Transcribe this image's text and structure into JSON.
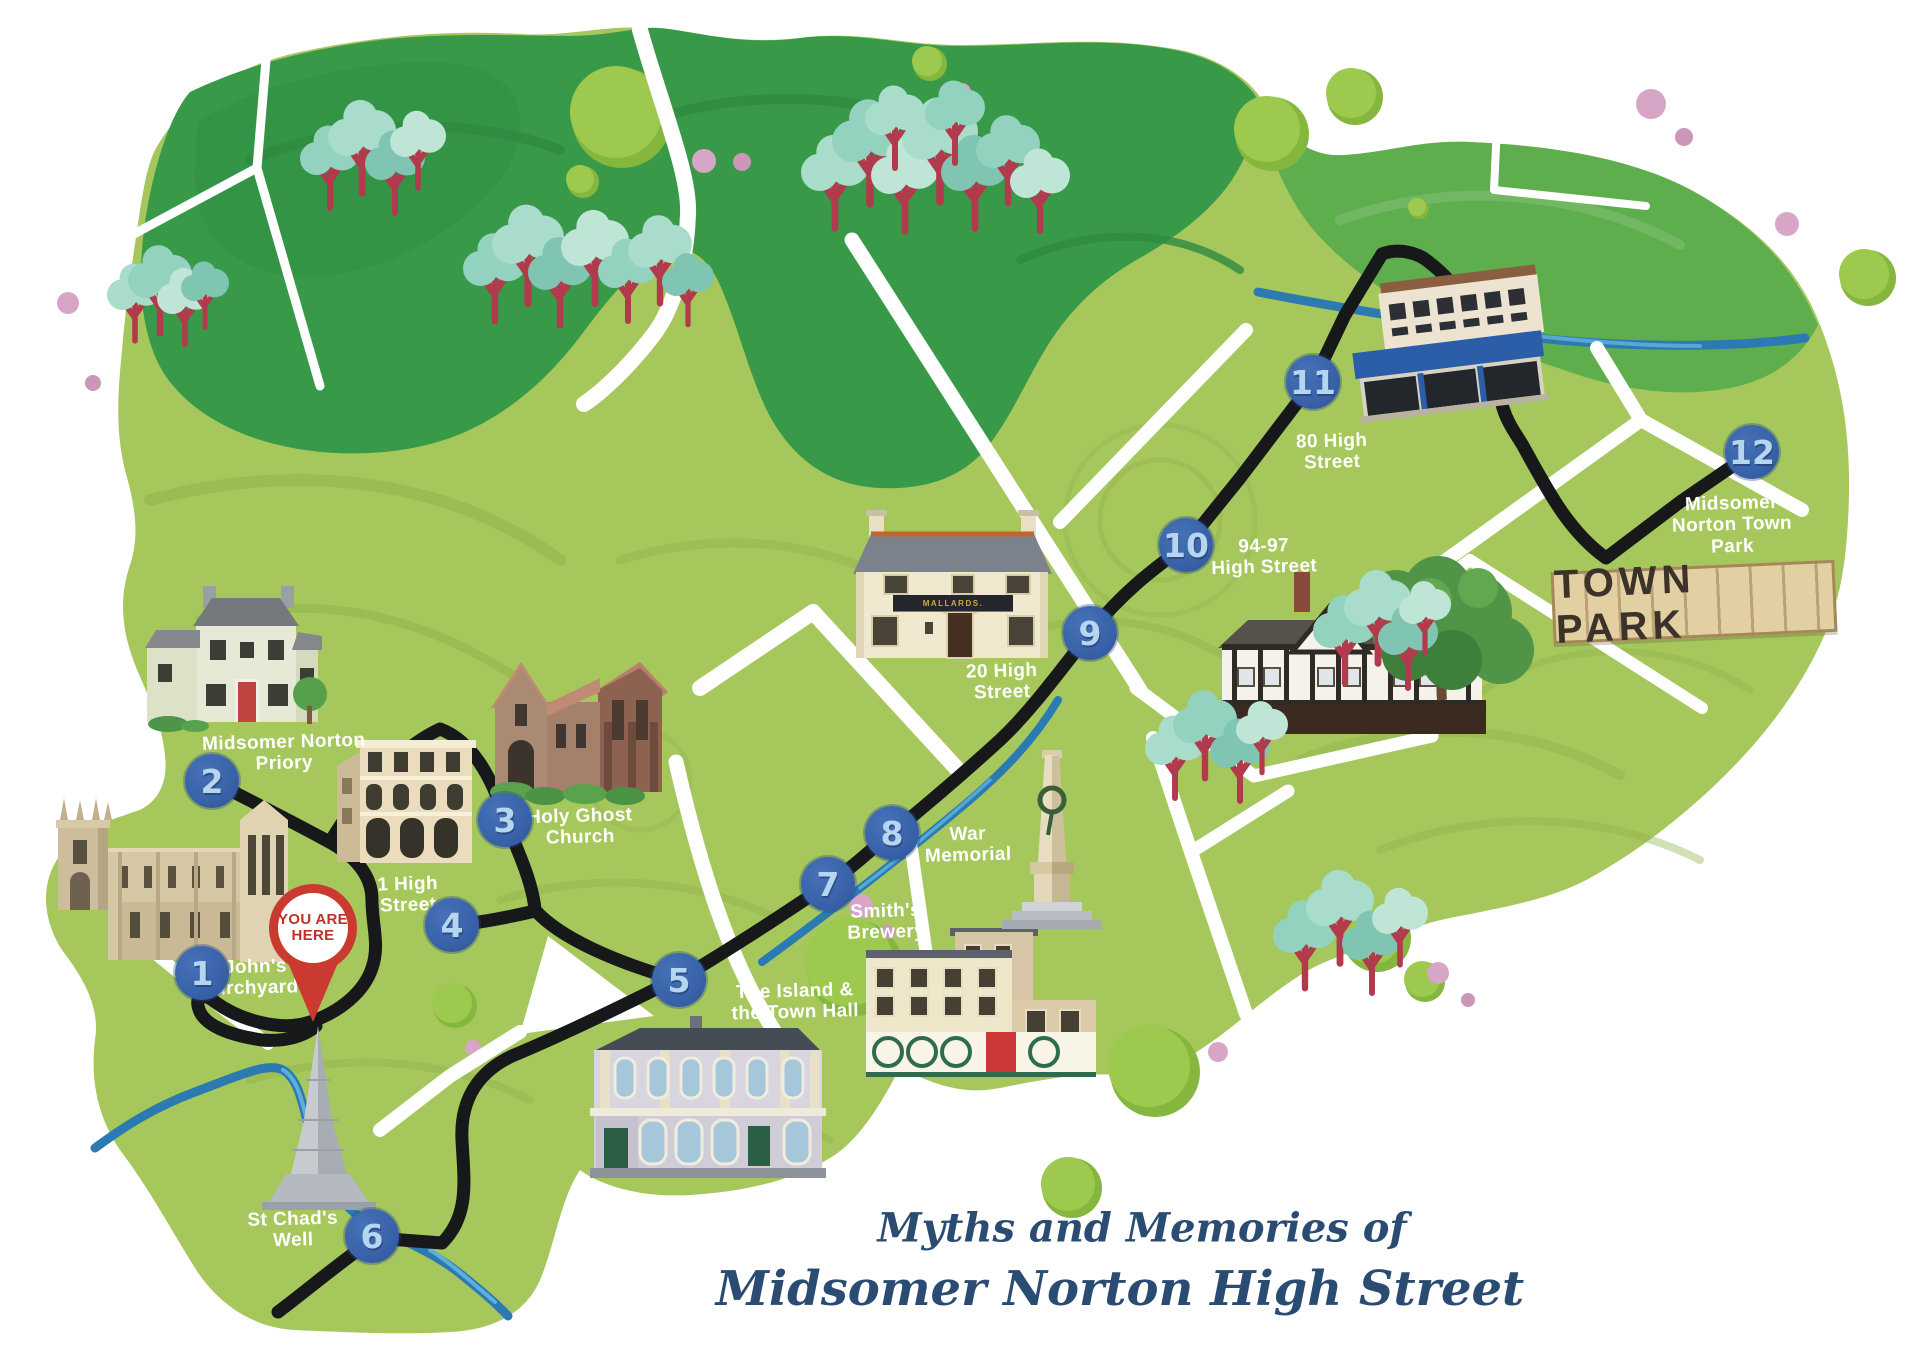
{
  "title": {
    "line1": "Myths and Memories of",
    "line2": "Midsomer Norton High Street"
  },
  "marker": {
    "you_are_here": "YOU ARE\nHERE"
  },
  "signs": {
    "town_park": "TOWN PARK",
    "building_20_high_street": "MALLARDS."
  },
  "stops": [
    {
      "number": "1",
      "label": "St John's\nChurchyard"
    },
    {
      "number": "2",
      "label": "Midsomer Norton\nPriory"
    },
    {
      "number": "3",
      "label": "Holy Ghost\nChurch"
    },
    {
      "number": "4",
      "label": "1 High\nStreet"
    },
    {
      "number": "5",
      "label": "The Island &\nthe Town Hall"
    },
    {
      "number": "6",
      "label": "St Chad's\nWell"
    },
    {
      "number": "7",
      "label": "Smith's\nBrewery"
    },
    {
      "number": "8",
      "label": "War\nMemorial"
    },
    {
      "number": "9",
      "label": "20 High\nStreet"
    },
    {
      "number": "10",
      "label": "94-97\nHigh Street"
    },
    {
      "number": "11",
      "label": "80 High\nStreet"
    },
    {
      "number": "12",
      "label": "Midsomer\nNorton Town\nPark"
    }
  ],
  "colors": {
    "grass_light": "#a5c75c",
    "forest_dark": "#389948",
    "grass_mid": "#5fae4d",
    "road_white": "#ffffff",
    "route_black": "#17181a",
    "river_blue": "#2b7ab2",
    "stop_marker_blue": "#3a63a9",
    "stop_number_blue": "#b5d6ee",
    "pin_red": "#cb3a31",
    "title_navy": "#2b4c72",
    "tree_teal": "#93d2bf",
    "tree_trunk_red": "#b23a4d",
    "dot_pink": "#d7a6c6",
    "sign_wood": "#e2cfa2",
    "sign_letters": "#3b332a"
  }
}
